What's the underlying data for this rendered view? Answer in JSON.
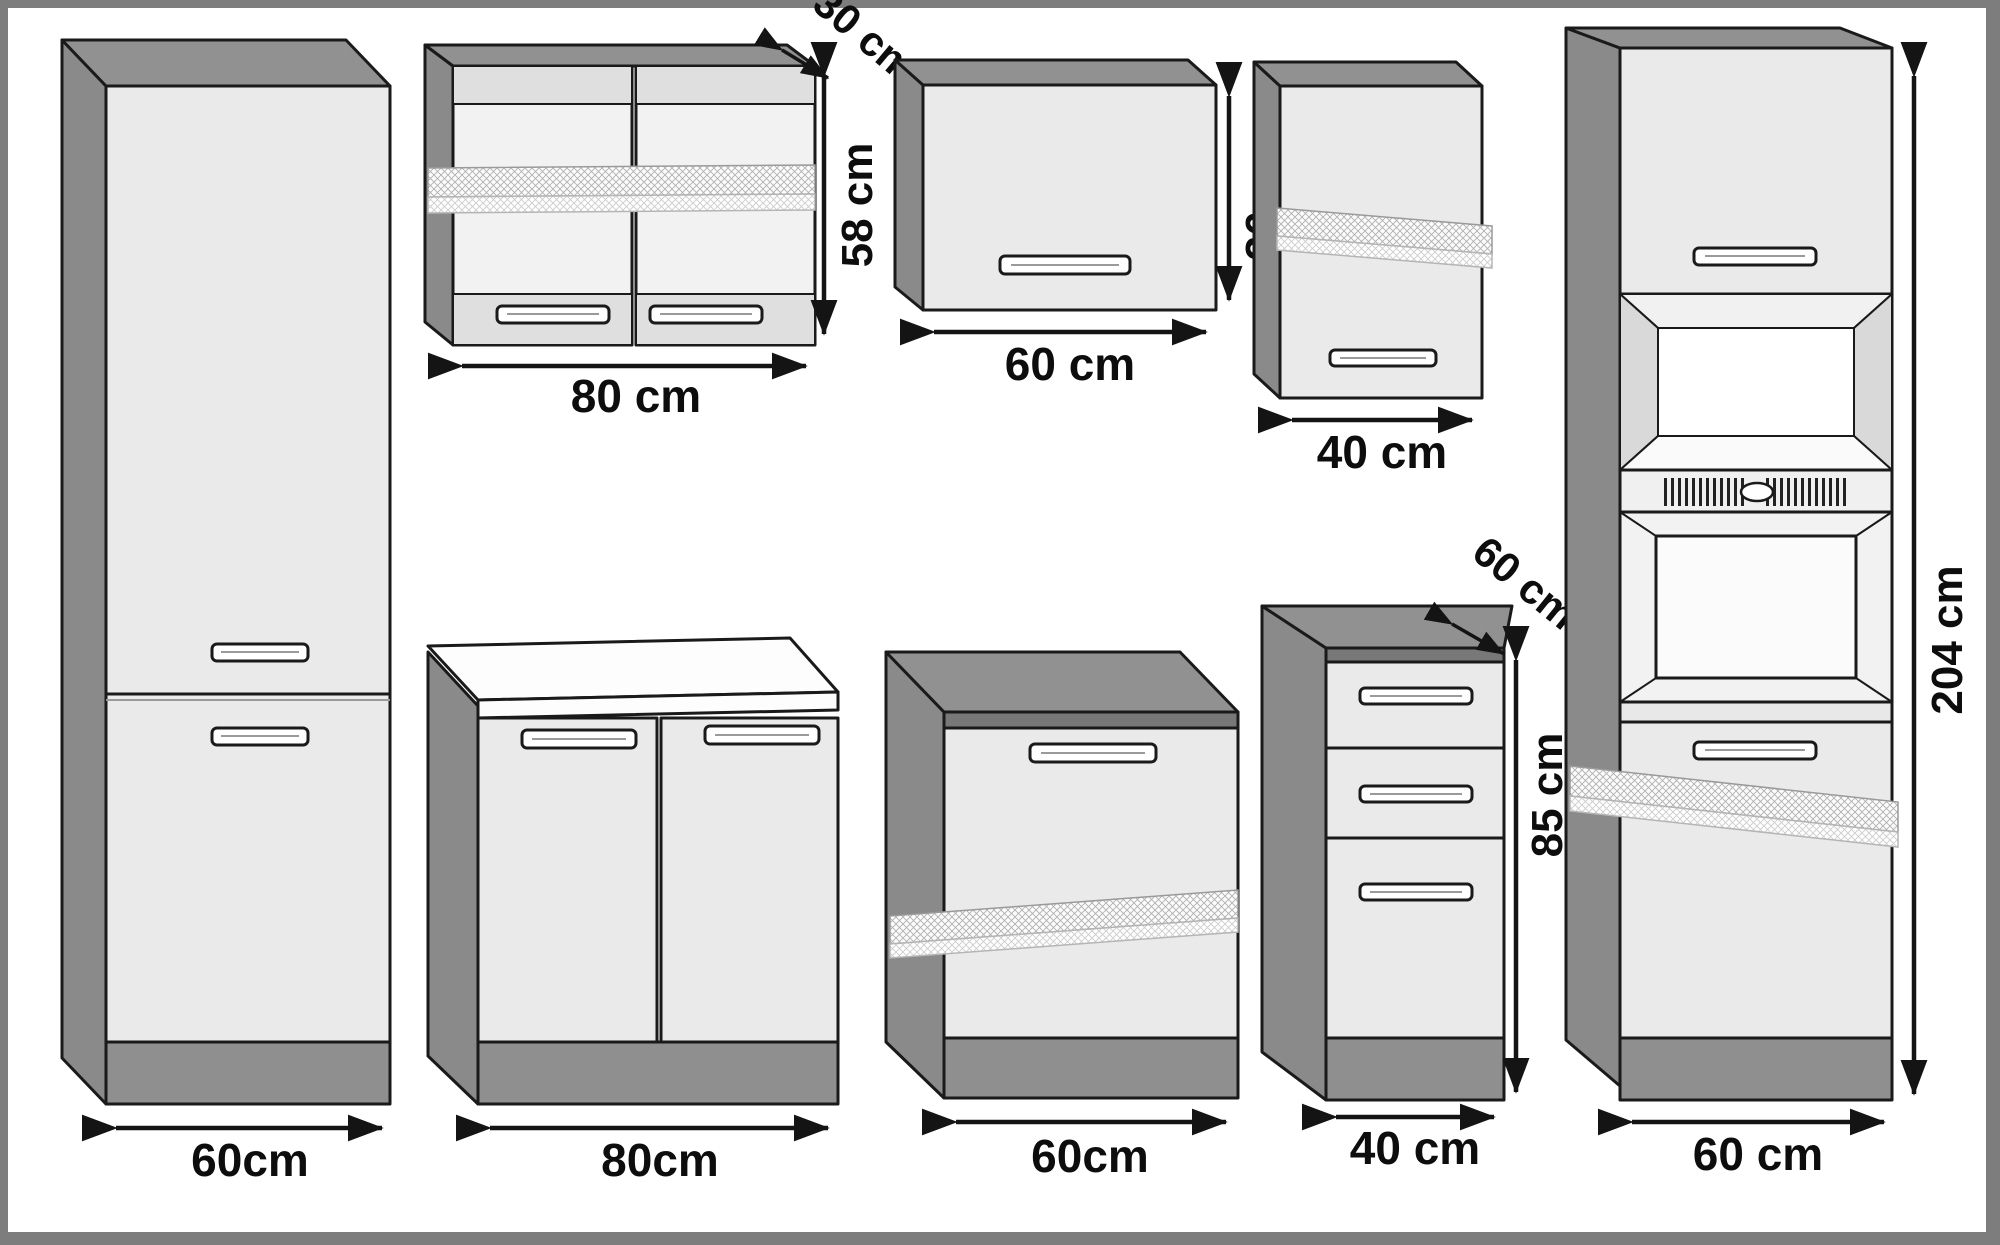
{
  "diagram_type": "kitchen-cabinet-dimension-drawing",
  "colors": {
    "frame": "#7d7d7d",
    "canvas": "#ffffff",
    "cabinet_front": "#eaeaea",
    "cabinet_side": "#8a8a8a",
    "cabinet_top": "#919191",
    "plinth": "#8f8f8f",
    "worktop": "#fdfdfd",
    "outline": "#1a1a1a",
    "label_text": "#0d0d0d"
  },
  "dimensions": {
    "tall_left": {
      "width": "60cm"
    },
    "wall_80": {
      "width": "80 cm",
      "height": "58 cm",
      "depth": "30 cm"
    },
    "wall_60": {
      "width": "60 cm",
      "height": "36 cm"
    },
    "wall_40": {
      "width": "40 cm"
    },
    "base_80": {
      "width": "80cm"
    },
    "base_60": {
      "width": "60cm"
    },
    "drawer_40": {
      "width": "40 cm",
      "height": "85 cm",
      "depth": "60 cm"
    },
    "oven_60": {
      "width": "60 cm",
      "height": "204 cm"
    }
  }
}
